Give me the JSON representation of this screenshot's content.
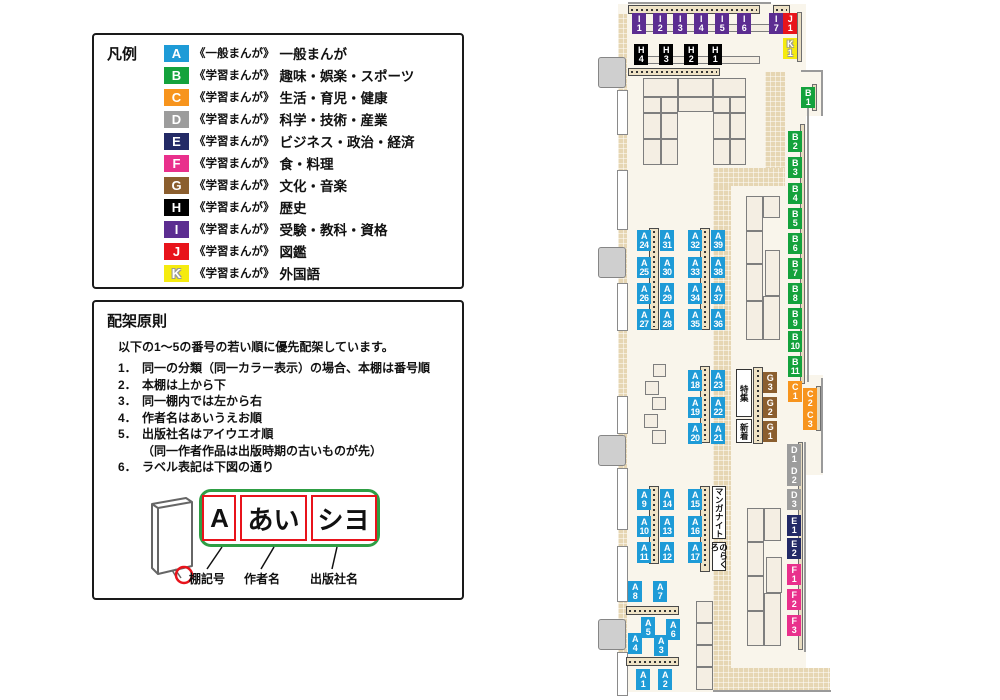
{
  "legend": {
    "title": "凡例",
    "items": [
      {
        "code": "A",
        "color": "#1E9BD7",
        "scope": "《一般まんが》",
        "label": "一般まんが"
      },
      {
        "code": "B",
        "color": "#14A23C",
        "scope": "《学習まんが》",
        "label": "趣味・娯楽・スポーツ"
      },
      {
        "code": "C",
        "color": "#F7941D",
        "scope": "《学習まんが》",
        "label": "生活・育児・健康"
      },
      {
        "code": "D",
        "color": "#9C9C9C",
        "scope": "《学習まんが》",
        "label": "科学・技術・産業"
      },
      {
        "code": "E",
        "color": "#232A66",
        "scope": "《学習まんが》",
        "label": "ビジネス・政治・経済"
      },
      {
        "code": "F",
        "color": "#E9308C",
        "scope": "《学習まんが》",
        "label": "食・料理"
      },
      {
        "code": "G",
        "color": "#8B5E2E",
        "scope": "《学習まんが》",
        "label": "文化・音楽"
      },
      {
        "code": "H",
        "color": "#000000",
        "scope": "《学習まんが》",
        "label": "歴史"
      },
      {
        "code": "I",
        "color": "#5C2D91",
        "scope": "《学習まんが》",
        "label": "受験・教科・資格"
      },
      {
        "code": "J",
        "color": "#E8141B",
        "scope": "《学習まんが》",
        "label": "図鑑"
      },
      {
        "code": "K",
        "color": "#F5EB0F",
        "scope": "《学習まんが》",
        "label": "外国語",
        "outline": true
      }
    ]
  },
  "principles": {
    "title": "配架原則",
    "intro": "以下の1～5の番号の若い順に優先配架しています。",
    "rules": [
      {
        "num": "1．",
        "text": "同一の分類（同一カラー表示）の場合、本棚は番号順"
      },
      {
        "num": "2．",
        "text": "本棚は上から下"
      },
      {
        "num": "3．",
        "text": "同一棚内では左から右"
      },
      {
        "num": "4．",
        "text": "作者名はあいうえお順"
      },
      {
        "num": "5．",
        "text": "出版社名はアイウエオ順",
        "sub": "（同一作者作品は出版時期の古いものが先）"
      },
      {
        "num": "6．",
        "text": "ラベル表記は下図の通り"
      }
    ],
    "diagram": {
      "boxes": [
        "A",
        "あい",
        "シヨ"
      ],
      "captions": [
        "棚記号",
        "作者名",
        "出版社名"
      ]
    }
  },
  "map": {
    "colors": {
      "A": "#1E9BD7",
      "B": "#14A23C",
      "C": "#F7941D",
      "D": "#9C9C9C",
      "E": "#232A66",
      "F": "#E9308C",
      "G": "#8B5E2E",
      "H": "#000000",
      "I": "#5C2D91",
      "J": "#E8141B",
      "K": "#F5EB0F"
    },
    "shelves": [
      {
        "c": "I1",
        "x": 37,
        "y": 13
      },
      {
        "c": "I2",
        "x": 58,
        "y": 13
      },
      {
        "c": "I3",
        "x": 78,
        "y": 13
      },
      {
        "c": "I4",
        "x": 99,
        "y": 13
      },
      {
        "c": "I5",
        "x": 120,
        "y": 13
      },
      {
        "c": "I6",
        "x": 142,
        "y": 13
      },
      {
        "c": "I7",
        "x": 174,
        "y": 13
      },
      {
        "c": "J1",
        "x": 188,
        "y": 13
      },
      {
        "c": "K1",
        "x": 188,
        "y": 38
      },
      {
        "c": "H4",
        "x": 39,
        "y": 44
      },
      {
        "c": "H3",
        "x": 64,
        "y": 44
      },
      {
        "c": "H2",
        "x": 89,
        "y": 44
      },
      {
        "c": "H1",
        "x": 113,
        "y": 44
      },
      {
        "c": "B1",
        "x": 206,
        "y": 87
      },
      {
        "c": "B2",
        "x": 193,
        "y": 131
      },
      {
        "c": "B3",
        "x": 193,
        "y": 157
      },
      {
        "c": "B4",
        "x": 193,
        "y": 183
      },
      {
        "c": "B5",
        "x": 193,
        "y": 208
      },
      {
        "c": "B6",
        "x": 193,
        "y": 233
      },
      {
        "c": "B7",
        "x": 193,
        "y": 258
      },
      {
        "c": "B8",
        "x": 193,
        "y": 283
      },
      {
        "c": "B9",
        "x": 193,
        "y": 308
      },
      {
        "c": "B10",
        "x": 193,
        "y": 331
      },
      {
        "c": "B11",
        "x": 193,
        "y": 356
      },
      {
        "c": "C1",
        "x": 193,
        "y": 381
      },
      {
        "c": "C2",
        "x": 208,
        "y": 388
      },
      {
        "c": "C3",
        "x": 208,
        "y": 409
      },
      {
        "c": "D1",
        "x": 192,
        "y": 444
      },
      {
        "c": "D2",
        "x": 192,
        "y": 465
      },
      {
        "c": "D3",
        "x": 192,
        "y": 489
      },
      {
        "c": "E1",
        "x": 192,
        "y": 515
      },
      {
        "c": "E2",
        "x": 192,
        "y": 538
      },
      {
        "c": "F1",
        "x": 192,
        "y": 564
      },
      {
        "c": "F2",
        "x": 192,
        "y": 589
      },
      {
        "c": "F3",
        "x": 192,
        "y": 615
      },
      {
        "c": "A24",
        "x": 42,
        "y": 230
      },
      {
        "c": "A25",
        "x": 42,
        "y": 257
      },
      {
        "c": "A26",
        "x": 42,
        "y": 283
      },
      {
        "c": "A27",
        "x": 42,
        "y": 309
      },
      {
        "c": "A31",
        "x": 65,
        "y": 230
      },
      {
        "c": "A30",
        "x": 65,
        "y": 257
      },
      {
        "c": "A29",
        "x": 65,
        "y": 283
      },
      {
        "c": "A28",
        "x": 65,
        "y": 309
      },
      {
        "c": "A32",
        "x": 93,
        "y": 230
      },
      {
        "c": "A33",
        "x": 93,
        "y": 257
      },
      {
        "c": "A34",
        "x": 93,
        "y": 283
      },
      {
        "c": "A35",
        "x": 93,
        "y": 309
      },
      {
        "c": "A39",
        "x": 116,
        "y": 230
      },
      {
        "c": "A38",
        "x": 116,
        "y": 257
      },
      {
        "c": "A37",
        "x": 116,
        "y": 283
      },
      {
        "c": "A36",
        "x": 116,
        "y": 309
      },
      {
        "c": "A18",
        "x": 93,
        "y": 370
      },
      {
        "c": "A19",
        "x": 93,
        "y": 397
      },
      {
        "c": "A20",
        "x": 93,
        "y": 423
      },
      {
        "c": "A23",
        "x": 116,
        "y": 370
      },
      {
        "c": "A22",
        "x": 116,
        "y": 397
      },
      {
        "c": "A21",
        "x": 116,
        "y": 423
      },
      {
        "c": "G3",
        "x": 168,
        "y": 372
      },
      {
        "c": "G2",
        "x": 168,
        "y": 397
      },
      {
        "c": "G1",
        "x": 168,
        "y": 421
      },
      {
        "c": "A9",
        "x": 42,
        "y": 489
      },
      {
        "c": "A10",
        "x": 42,
        "y": 516
      },
      {
        "c": "A11",
        "x": 42,
        "y": 542
      },
      {
        "c": "A14",
        "x": 65,
        "y": 489
      },
      {
        "c": "A13",
        "x": 65,
        "y": 516
      },
      {
        "c": "A12",
        "x": 65,
        "y": 542
      },
      {
        "c": "A15",
        "x": 93,
        "y": 489
      },
      {
        "c": "A16",
        "x": 93,
        "y": 516
      },
      {
        "c": "A17",
        "x": 93,
        "y": 542
      },
      {
        "c": "A8",
        "x": 33,
        "y": 581
      },
      {
        "c": "A7",
        "x": 58,
        "y": 581
      },
      {
        "c": "A5",
        "x": 46,
        "y": 617
      },
      {
        "c": "A6",
        "x": 71,
        "y": 619
      },
      {
        "c": "A4",
        "x": 33,
        "y": 633
      },
      {
        "c": "A3",
        "x": 59,
        "y": 635
      },
      {
        "c": "A1",
        "x": 41,
        "y": 669
      },
      {
        "c": "A2",
        "x": 63,
        "y": 669
      }
    ],
    "area_labels": [
      {
        "text": "特集",
        "x": 141,
        "y": 369,
        "w": 16,
        "h": 48
      },
      {
        "text": "新着",
        "x": 141,
        "y": 419,
        "w": 16,
        "h": 24
      },
      {
        "text": "マンガナイト",
        "x": 117,
        "y": 486,
        "w": 14,
        "h": 53
      },
      {
        "text": "のらくろ",
        "x": 117,
        "y": 542,
        "w": 14,
        "h": 29
      }
    ],
    "floor": [
      [
        23,
        4,
        188,
        688
      ],
      [
        207,
        70,
        20,
        46
      ],
      [
        208,
        375,
        20,
        100
      ]
    ],
    "hatch": [
      [
        23,
        14,
        9,
        676
      ],
      [
        170,
        72,
        20,
        104
      ],
      [
        118,
        168,
        72,
        18
      ],
      [
        118,
        186,
        18,
        504
      ],
      [
        118,
        668,
        117,
        22
      ]
    ],
    "lines": [
      [
        212,
        96,
        2,
        286
      ],
      [
        226,
        378,
        2,
        95
      ],
      [
        209,
        442,
        2,
        210
      ],
      [
        118,
        690,
        118,
        2
      ],
      [
        206,
        70,
        22,
        2
      ],
      [
        226,
        70,
        2,
        46
      ],
      [
        33,
        2,
        143,
        2
      ]
    ],
    "doors": [
      [
        3,
        57,
        28,
        31
      ],
      [
        3,
        247,
        28,
        31
      ],
      [
        3,
        435,
        28,
        31
      ],
      [
        3,
        619,
        28,
        31
      ]
    ],
    "wall_segs": [
      [
        22,
        90,
        11,
        45
      ],
      [
        22,
        170,
        11,
        60
      ],
      [
        22,
        283,
        11,
        48
      ],
      [
        22,
        396,
        11,
        38
      ],
      [
        22,
        468,
        11,
        62
      ],
      [
        22,
        546,
        11,
        56
      ],
      [
        22,
        652,
        11,
        44
      ]
    ],
    "tables": [
      [
        48,
        78,
        35,
        19
      ],
      [
        83,
        78,
        35,
        19
      ],
      [
        118,
        78,
        33,
        19
      ],
      [
        48,
        97,
        18,
        16
      ],
      [
        66,
        97,
        17,
        16
      ],
      [
        83,
        97,
        35,
        15
      ],
      [
        118,
        97,
        17,
        16
      ],
      [
        135,
        97,
        16,
        16
      ],
      [
        48,
        113,
        18,
        26
      ],
      [
        66,
        113,
        17,
        26
      ],
      [
        48,
        139,
        18,
        26
      ],
      [
        66,
        139,
        17,
        26
      ],
      [
        118,
        113,
        17,
        26
      ],
      [
        135,
        113,
        16,
        26
      ],
      [
        118,
        139,
        17,
        26
      ],
      [
        135,
        139,
        16,
        26
      ],
      [
        151,
        196,
        17,
        35
      ],
      [
        168,
        196,
        17,
        22
      ],
      [
        151,
        231,
        17,
        33
      ],
      [
        151,
        264,
        17,
        37
      ],
      [
        170,
        250,
        15,
        46
      ],
      [
        151,
        301,
        17,
        39
      ],
      [
        168,
        296,
        17,
        44
      ],
      [
        152,
        508,
        17,
        34
      ],
      [
        169,
        508,
        17,
        33
      ],
      [
        152,
        542,
        17,
        34
      ],
      [
        152,
        576,
        17,
        35
      ],
      [
        171,
        557,
        16,
        36
      ],
      [
        152,
        611,
        17,
        35
      ],
      [
        169,
        593,
        17,
        53
      ],
      [
        101,
        601,
        17,
        22
      ],
      [
        101,
        623,
        17,
        22
      ],
      [
        101,
        645,
        17,
        22
      ],
      [
        101,
        667,
        17,
        23
      ],
      [
        58,
        364,
        13,
        13
      ],
      [
        50,
        381,
        14,
        14
      ],
      [
        57,
        397,
        14,
        13
      ],
      [
        49,
        414,
        14,
        14
      ],
      [
        57,
        430,
        14,
        14
      ],
      [
        44,
        24,
        133,
        8
      ],
      [
        47,
        56,
        118,
        8
      ]
    ],
    "strips_dashed_v": [
      [
        54,
        228,
        10,
        102
      ],
      [
        105,
        228,
        10,
        102
      ],
      [
        105,
        366,
        10,
        77
      ],
      [
        158,
        367,
        10,
        77
      ],
      [
        54,
        486,
        10,
        78
      ],
      [
        105,
        486,
        10,
        86
      ]
    ],
    "strips_dashed_h": [
      [
        33,
        5,
        132,
        9
      ],
      [
        178,
        5,
        17,
        9
      ],
      [
        33,
        68,
        92,
        8
      ],
      [
        31,
        606,
        53,
        9
      ],
      [
        31,
        657,
        53,
        9
      ]
    ],
    "strips_plain": [
      [
        202,
        12,
        5,
        50
      ],
      [
        217,
        84,
        5,
        27
      ],
      [
        205,
        124,
        5,
        260
      ],
      [
        221,
        386,
        5,
        45
      ],
      [
        203,
        442,
        5,
        208
      ]
    ]
  }
}
